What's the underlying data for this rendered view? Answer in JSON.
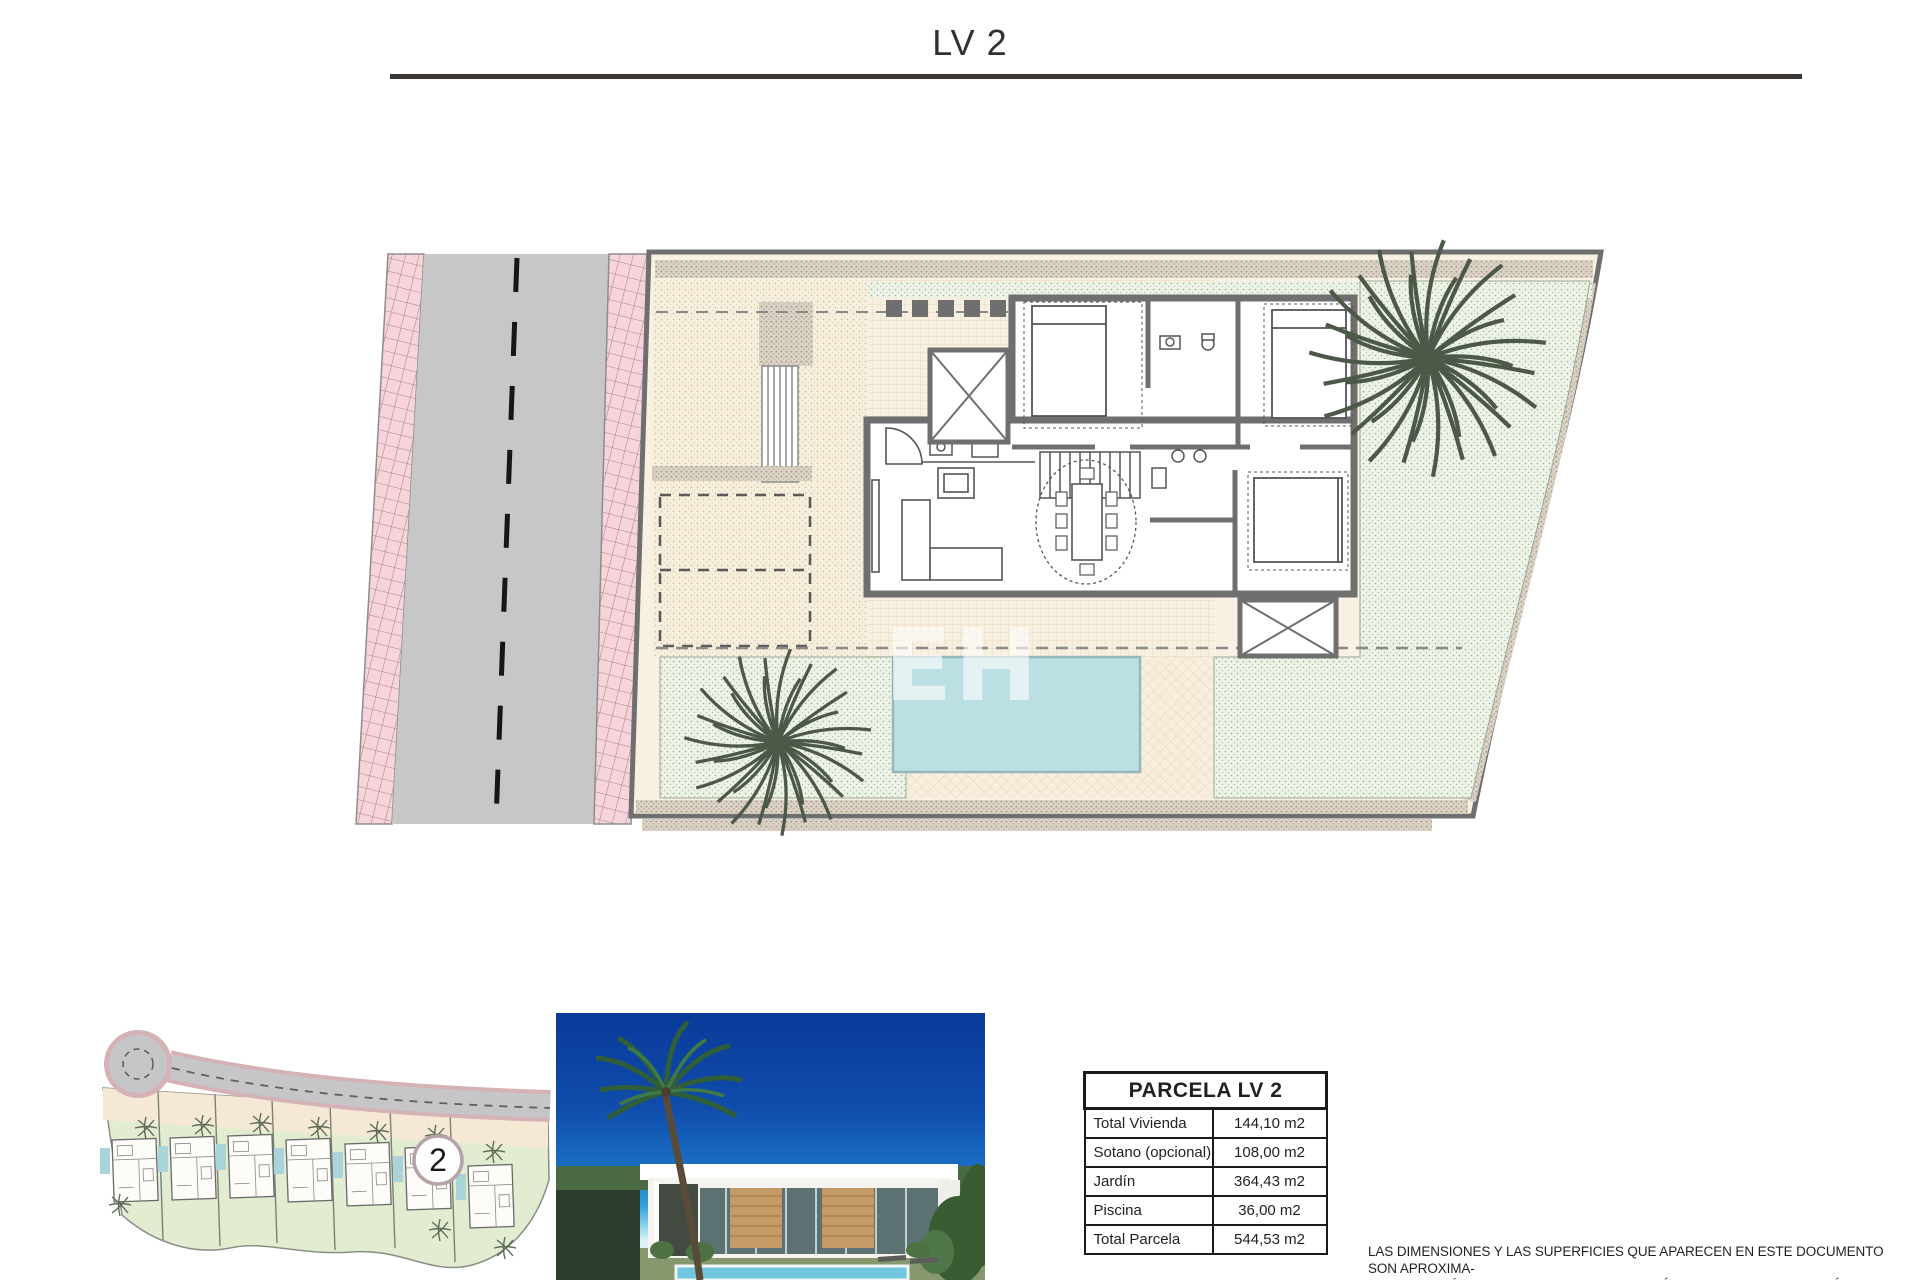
{
  "header": {
    "title": "LV 2"
  },
  "plan": {
    "watermark": "EH"
  },
  "site_map": {
    "parcel_marker": "2"
  },
  "table": {
    "title": "PARCELA LV 2",
    "rows": [
      {
        "label": "Total Vivienda",
        "value": "144,10 m2"
      },
      {
        "label": "Sotano (opcional)",
        "value": "108,00 m2"
      },
      {
        "label": "Jardín",
        "value": "364,43 m2"
      },
      {
        "label": "Piscina",
        "value": "36,00 m2"
      },
      {
        "label": "Total Parcela",
        "value": "544,53 m2"
      }
    ]
  },
  "disclaimer": {
    "line1": "LAS DIMENSIONES Y LAS SUPERFICIES QUE APARECEN EN ESTE DOCUMENTO SON APROXIMA-",
    "line2": "DAS Y PODRÁN SER OBJETO DE MODIFICACIÓN DURANTE LA REDACCIÓN DE LOS PROYECTOS",
    "line3": "BÁSICO Y DE EJECUCIÓN."
  },
  "colors": {
    "road": "#c7c7c8",
    "sidewalk_pink": "#f6d4d9",
    "plot_cream": "#f8f1e2",
    "garden_mint": "#ecf2e6",
    "pool_blue": "#bcdfe3",
    "wall_gray": "#6f6f6f",
    "sky_blue": "#0a3a9a"
  }
}
